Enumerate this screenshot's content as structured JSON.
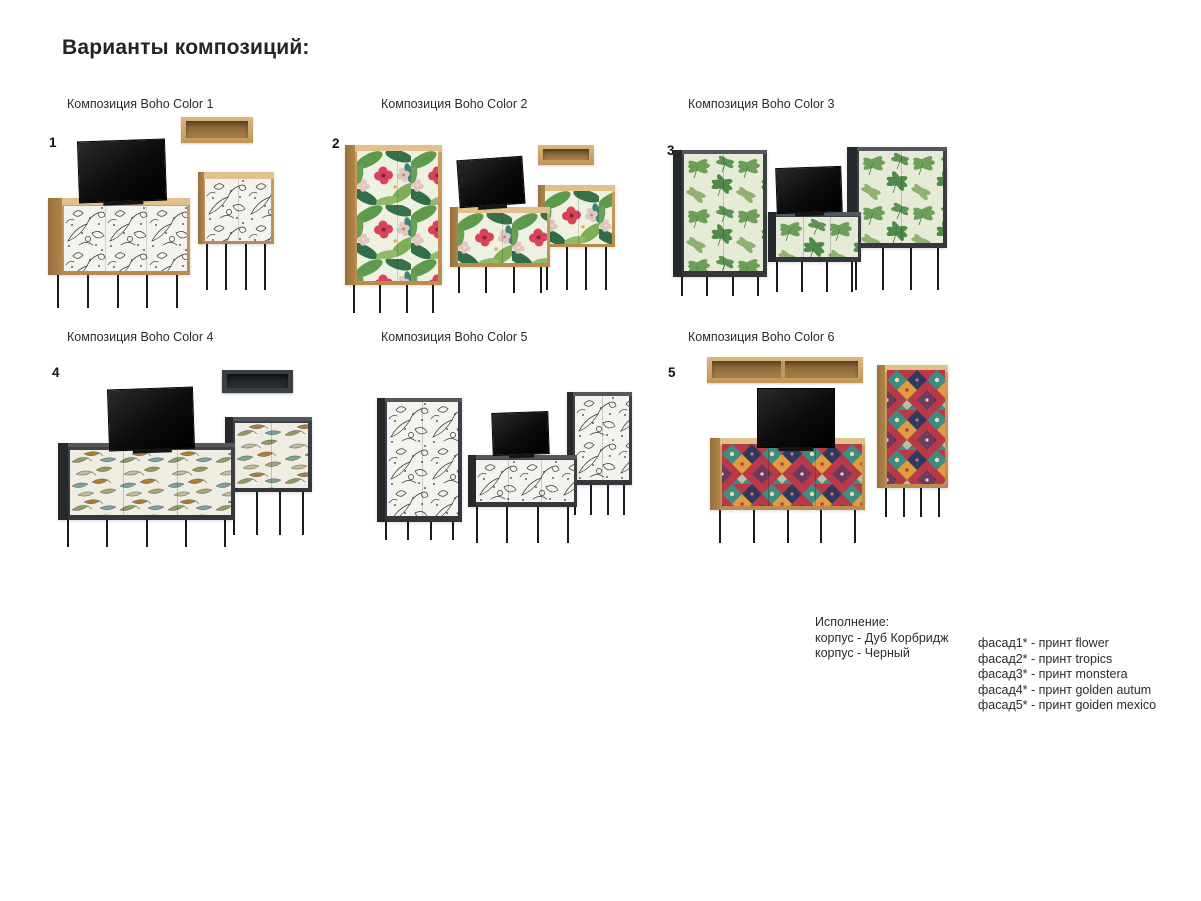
{
  "page": {
    "title": "Варианты композиций:"
  },
  "compositions": [
    {
      "number": "1",
      "label": "Композиция Boho Color 1",
      "print": "flower",
      "body": "Дуб Корбридж"
    },
    {
      "number": "2",
      "label": "Композиция Boho Color 2",
      "print": "tropics",
      "body": "Дуб Корбридж"
    },
    {
      "number": "3",
      "label": "Композиция Boho Color 3",
      "print": "monstera",
      "body": "Черный"
    },
    {
      "number": "4",
      "label": "Композиция Boho Color 4",
      "print": "golden autum",
      "body": "Черный"
    },
    {
      "number": "",
      "label": "Композиция Boho Color 5",
      "print": "flower",
      "body": "Черный"
    },
    {
      "number": "5",
      "label": "Композиция Boho Color 6",
      "print": "goiden mexico",
      "body": "Дуб Корбридж"
    }
  ],
  "legend": {
    "title": "Исполнение:",
    "body_options": [
      "корпус - Дуб Корбридж",
      "корпус - Черный"
    ],
    "facade_options": [
      "фасад1* - принт flower",
      "фасад2* - принт tropics",
      "фасад3* - принт monstera",
      "фасад4* - принт golden autum",
      "фасад5* - принт goiden mexico"
    ]
  },
  "colors": {
    "background": "#ffffff",
    "text": "#262626",
    "oak_light": "#e2c089",
    "oak": "#c69757",
    "oak_dark": "#a07746",
    "dark_body": "#3f4347",
    "dark_side": "#26292c",
    "leg_black": "#191a1c",
    "tv_black": "#0b0b0b",
    "print_flower_bg": "#f4f3f0",
    "print_flower_line": "#35342f",
    "print_tropics_green": "#5e9a4b",
    "print_tropics_red": "#d6435a",
    "print_monstera_bg": "#e6ebd8",
    "print_monstera_green": "#5d9150",
    "print_autumn_bg": "#efece1",
    "print_autumn_olive": "#939a63",
    "print_autumn_brown": "#b07c3c",
    "print_autumn_teal": "#7aa4a0",
    "print_mexico_red": "#b93a46",
    "print_mexico_teal": "#3c8c84",
    "print_mexico_orange": "#df9d3f",
    "print_mexico_purple": "#6c3a5f",
    "print_mexico_navy": "#2c3a60"
  }
}
